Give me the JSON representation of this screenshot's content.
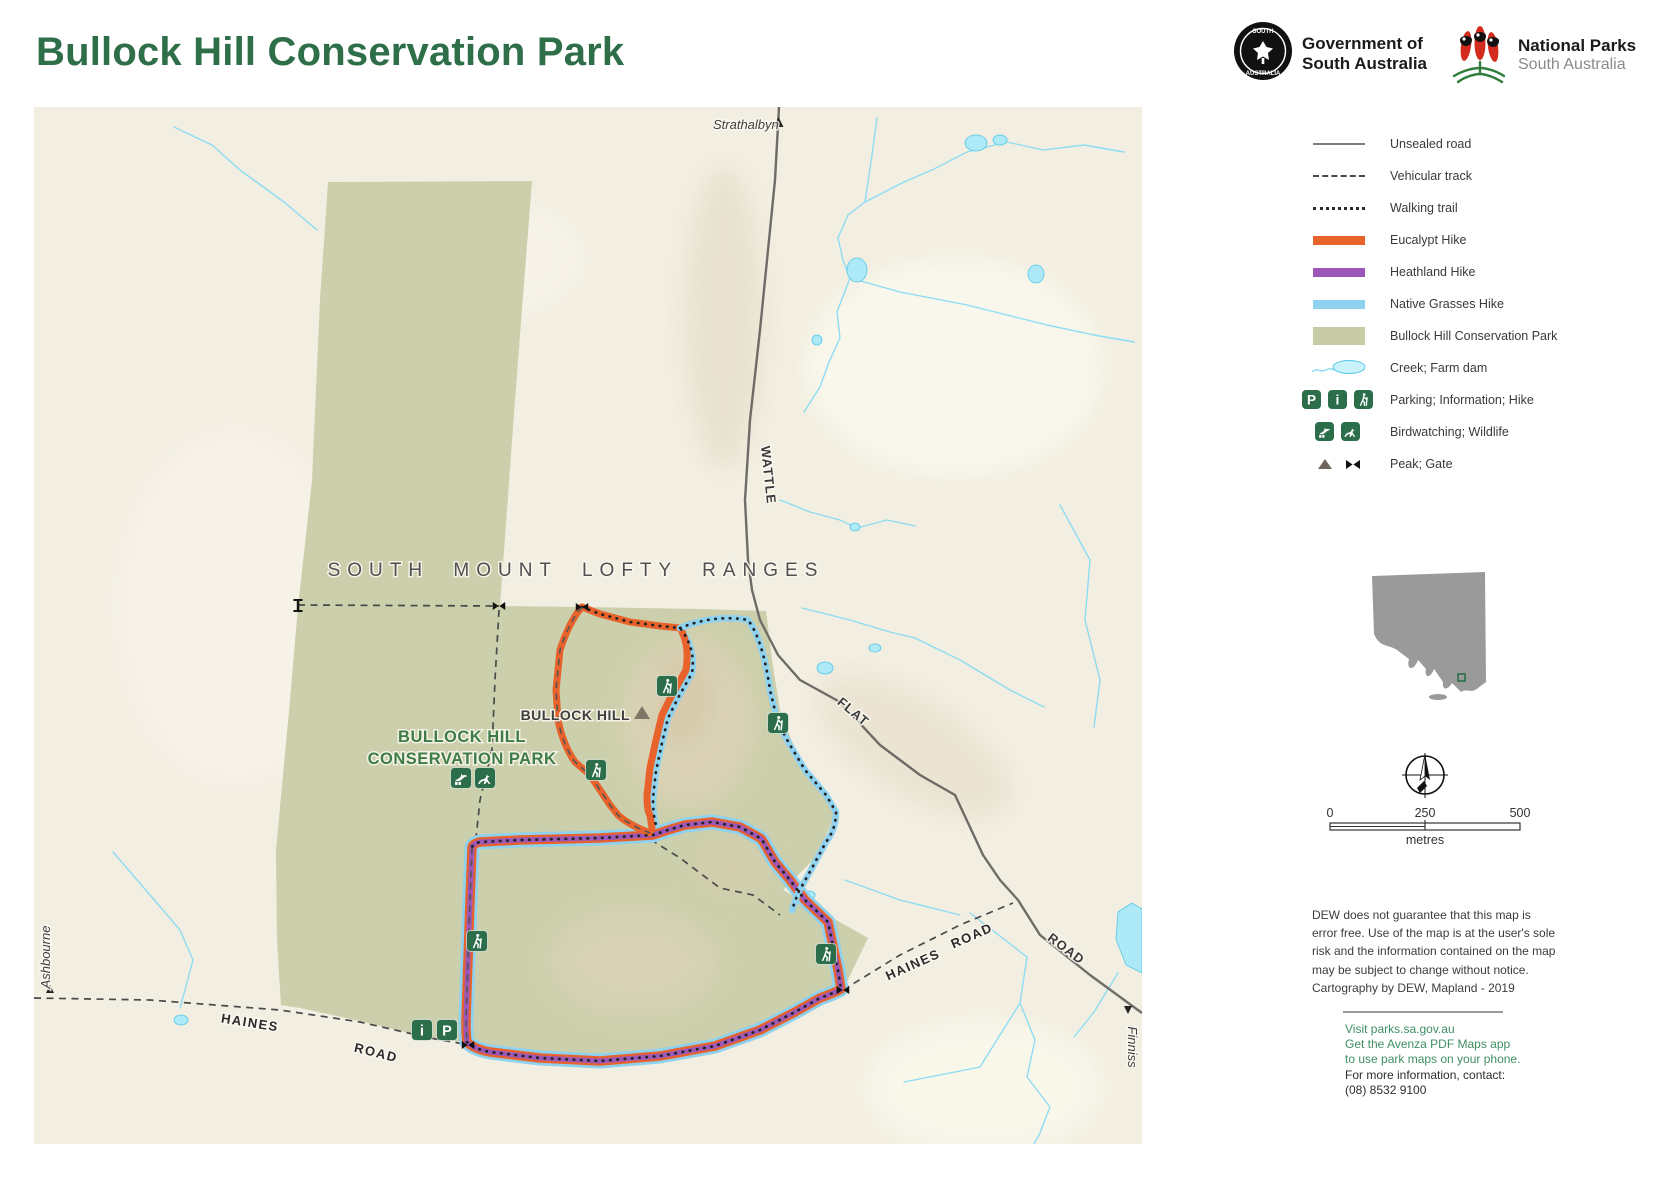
{
  "header": {
    "title": "Bullock Hill Conservation Park",
    "government_logo": {
      "line1": "Government of",
      "line2": "South Australia"
    },
    "national_parks_logo": {
      "line1": "National Parks",
      "line2": "South Australia"
    }
  },
  "map": {
    "labels": {
      "region": "SOUTH MOUNT LOFTY RANGES",
      "peak": "BULLOCK HILL",
      "park_line1": "BULLOCK HILL",
      "park_line2": "CONSERVATION PARK",
      "town_north": "Strathalbyn",
      "town_west": "Ashbourne",
      "town_southeast": "Finniss",
      "road_wattle": "WATTLE",
      "road_flat": "FLAT",
      "haines_west": "HAINES",
      "road_west": "ROAD",
      "haines_east": "HAINES",
      "road_east": "ROAD",
      "road_southeast": "ROAD"
    },
    "icons": {
      "parking_letter": "P",
      "information_letter": "i"
    }
  },
  "legend": {
    "items": [
      {
        "label": "Unsealed road",
        "symbol": "solid-line"
      },
      {
        "label": "Vehicular track",
        "symbol": "dashed-line"
      },
      {
        "label": "Walking trail",
        "symbol": "dotted-line"
      },
      {
        "label": "Eucalypt Hike",
        "symbol": "orange-bar",
        "color": "#e8622b"
      },
      {
        "label": "Heathland Hike",
        "symbol": "purple-bar",
        "color": "#9c57b8"
      },
      {
        "label": "Native Grasses Hike",
        "symbol": "blue-bar",
        "color": "#8fd2f0"
      },
      {
        "label": "Bullock Hill Conservation Park",
        "symbol": "park-fill",
        "color": "#c8cca6"
      },
      {
        "label": "Creek; Farm dam",
        "symbol": "creek-dam"
      },
      {
        "label": "Parking; Information; Hike",
        "symbol": "parking-information-hike-icons"
      },
      {
        "label": "Birdwatching; Wildlife",
        "symbol": "birdwatching-wildlife-icons"
      },
      {
        "label": "Peak; Gate",
        "symbol": "peak-gate-symbols"
      }
    ]
  },
  "scalebar": {
    "start": "0",
    "middle": "250",
    "end": "500",
    "unit": "metres"
  },
  "disclaimer": {
    "lines": [
      "DEW does not guarantee that this map is",
      "error free. Use of the map is at the user's sole",
      "risk and the information contained on the map",
      "may be subject to change without notice.",
      "Cartography by DEW, Mapland - 2019"
    ]
  },
  "footer": {
    "link": "Visit parks.sa.gov.au",
    "app_line1": "Get the Avenza PDF Maps app",
    "app_line2": "to use park maps on your phone.",
    "contact_line1": "For more information, contact:",
    "contact_line2": "(08) 8532 9100"
  },
  "colors": {
    "title_green": "#2e6e49",
    "park_fill": "#c8cca6",
    "park_label_green": "#3e7c46",
    "icon_green": "#2c6e4a",
    "eucalypt_orange": "#e8622b",
    "heathland_purple": "#9c57b8",
    "native_grasses_blue": "#8fd2f0",
    "creek_blue": "#8ddcf3",
    "road_gray": "#6f6b66",
    "footer_green": "#3f8f63",
    "background_cream": "#f2eee1"
  }
}
